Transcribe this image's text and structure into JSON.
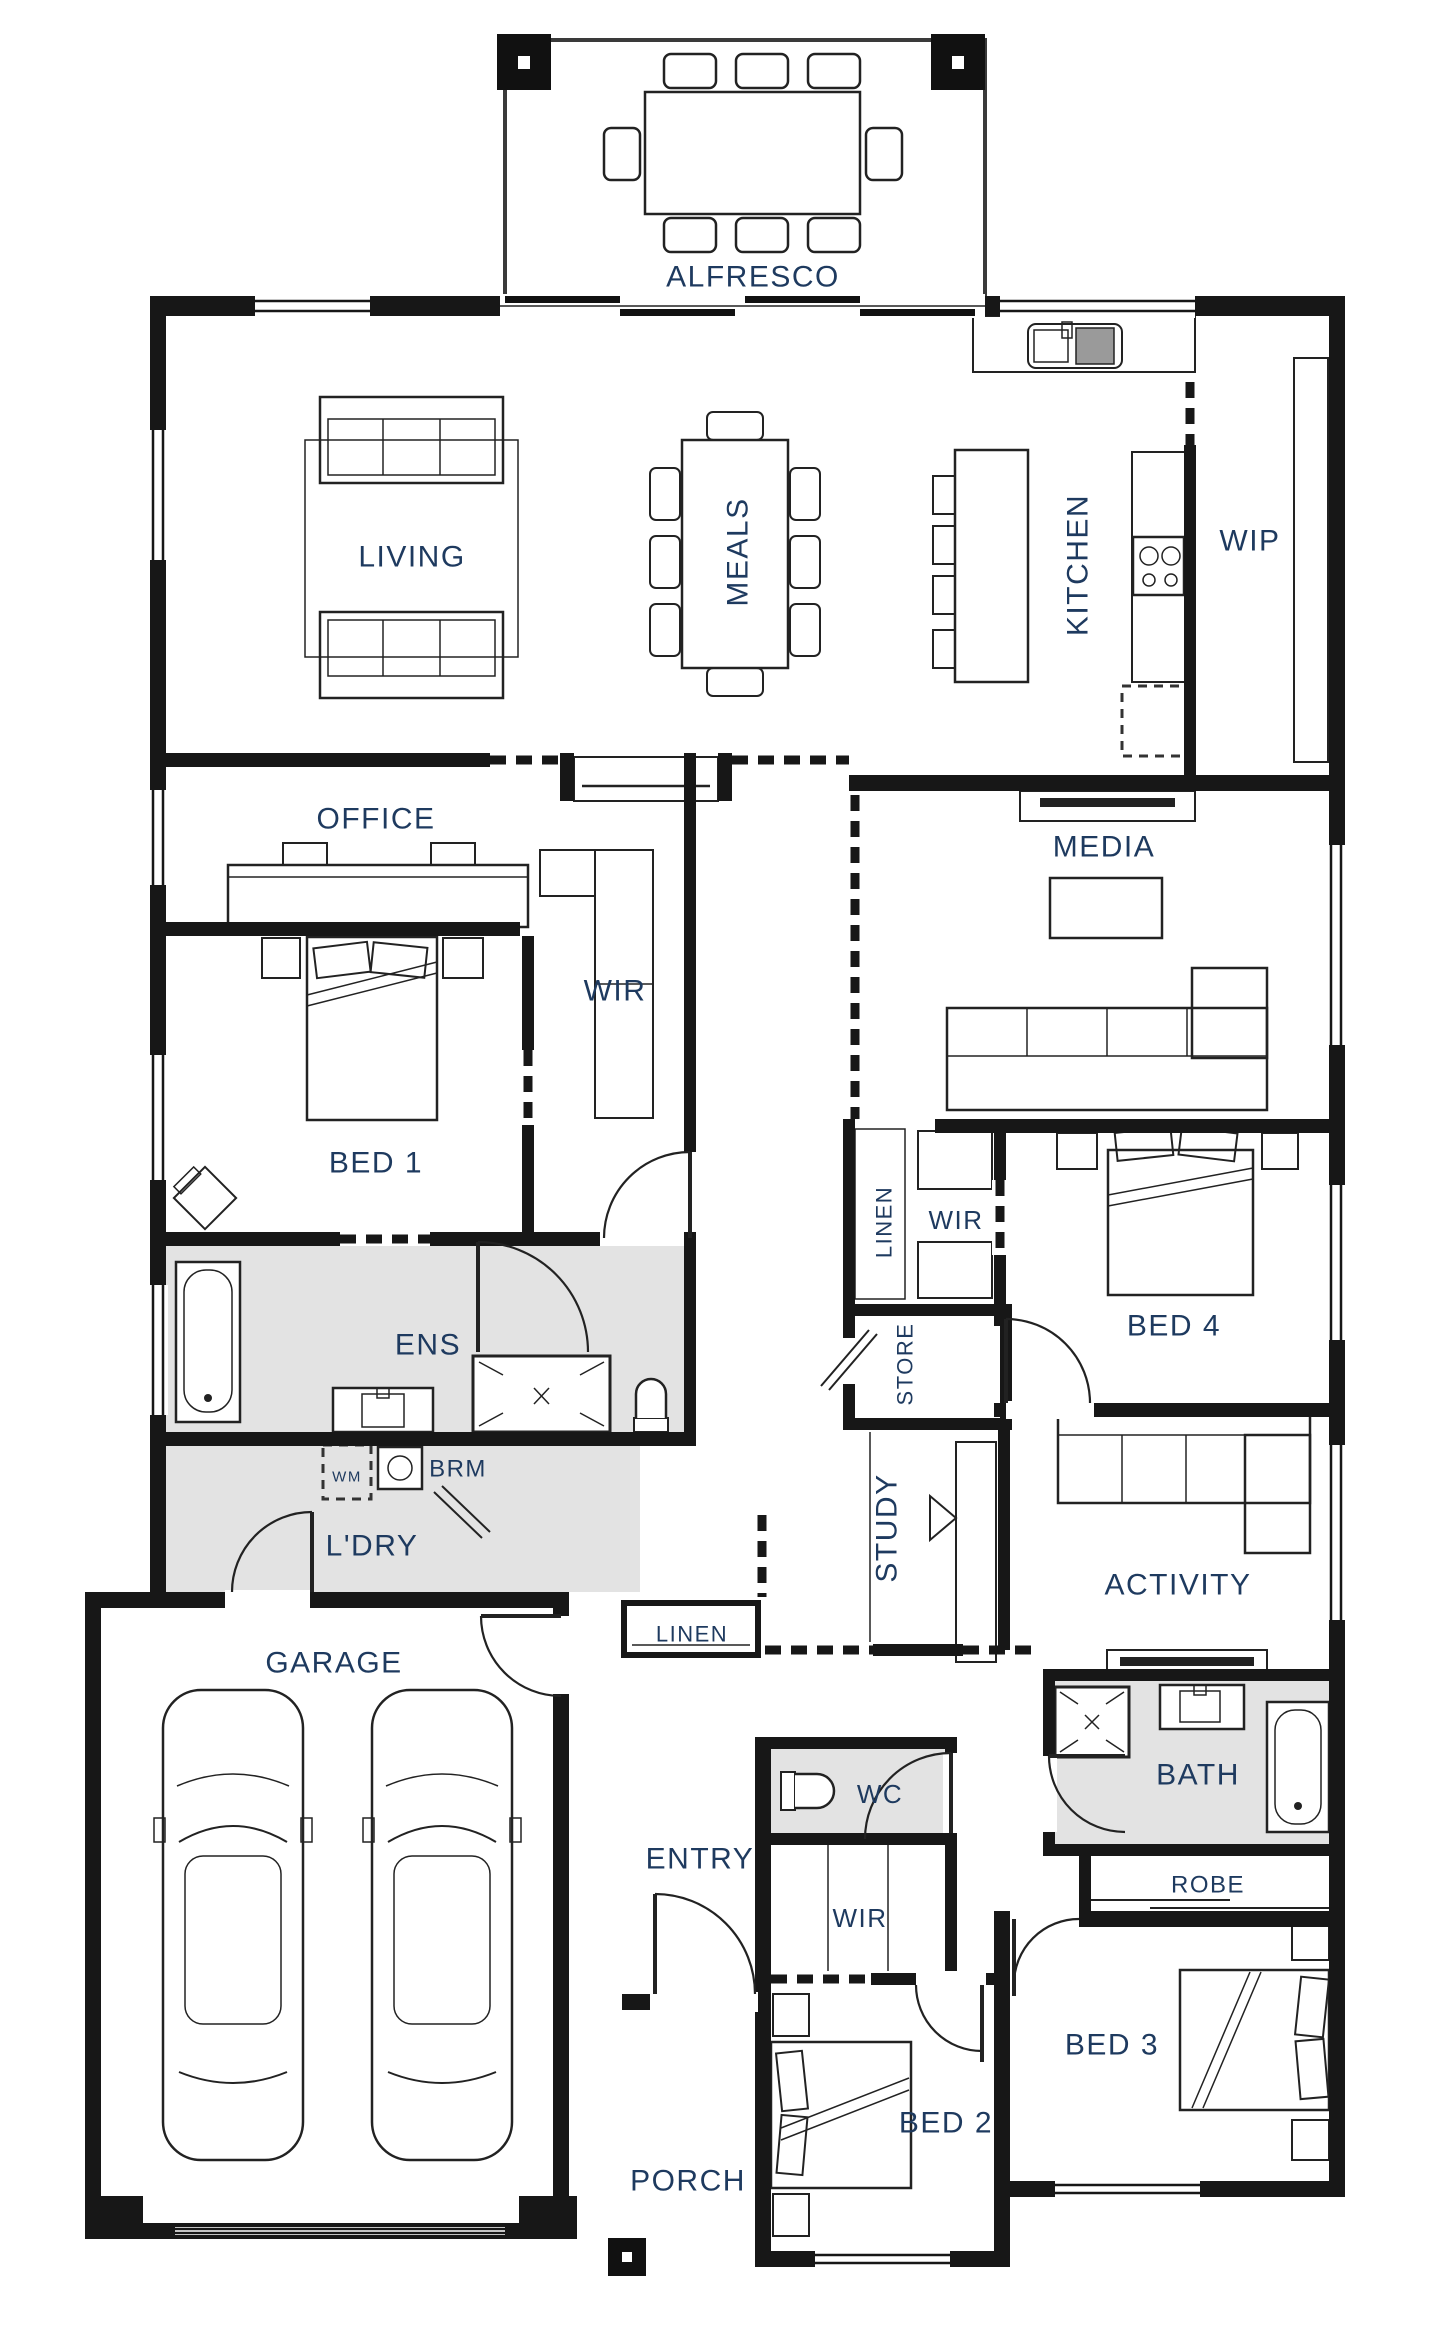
{
  "plan": {
    "type": "residential-floor-plan",
    "colors": {
      "wall": "#171717",
      "label": "#1e3a5f",
      "wet_area": "#e3e3e3",
      "furniture_line": "#222222",
      "background": "#ffffff"
    },
    "canvas": {
      "width": 1440,
      "height": 2340
    },
    "rooms": [
      {
        "id": "alfresco",
        "label": "ALFRESCO",
        "x": 753,
        "y": 276,
        "size": 30,
        "rotate": 0
      },
      {
        "id": "living",
        "label": "LIVING",
        "x": 412,
        "y": 556,
        "size": 30,
        "rotate": 0
      },
      {
        "id": "meals",
        "label": "MEALS",
        "x": 737,
        "y": 552,
        "size": 30,
        "rotate": -90
      },
      {
        "id": "kitchen",
        "label": "KITCHEN",
        "x": 1077,
        "y": 565,
        "size": 30,
        "rotate": -90
      },
      {
        "id": "wip",
        "label": "WIP",
        "x": 1250,
        "y": 540,
        "size": 30,
        "rotate": 0
      },
      {
        "id": "office",
        "label": "OFFICE",
        "x": 376,
        "y": 818,
        "size": 30,
        "rotate": 0
      },
      {
        "id": "media",
        "label": "MEDIA",
        "x": 1104,
        "y": 846,
        "size": 30,
        "rotate": 0
      },
      {
        "id": "wir-bed1",
        "label": "WIR",
        "x": 615,
        "y": 990,
        "size": 30,
        "rotate": 0
      },
      {
        "id": "bed1",
        "label": "BED 1",
        "x": 376,
        "y": 1162,
        "size": 30,
        "rotate": 0
      },
      {
        "id": "linen-hall",
        "label": "LINEN",
        "x": 884,
        "y": 1222,
        "size": 22,
        "rotate": -90
      },
      {
        "id": "wir-bed4",
        "label": "WIR",
        "x": 956,
        "y": 1220,
        "size": 26,
        "rotate": 0
      },
      {
        "id": "bed4",
        "label": "BED 4",
        "x": 1174,
        "y": 1325,
        "size": 30,
        "rotate": 0
      },
      {
        "id": "ens",
        "label": "ENS",
        "x": 428,
        "y": 1344,
        "size": 30,
        "rotate": 0
      },
      {
        "id": "store",
        "label": "STORE",
        "x": 905,
        "y": 1364,
        "size": 22,
        "rotate": -90
      },
      {
        "id": "wm",
        "label": "WM",
        "x": 347,
        "y": 1476,
        "size": 15,
        "rotate": 0
      },
      {
        "id": "brm",
        "label": "BRM",
        "x": 458,
        "y": 1468,
        "size": 24,
        "rotate": 0
      },
      {
        "id": "ldry",
        "label": "L'DRY",
        "x": 372,
        "y": 1545,
        "size": 30,
        "rotate": 0
      },
      {
        "id": "study",
        "label": "STUDY",
        "x": 886,
        "y": 1528,
        "size": 30,
        "rotate": -90
      },
      {
        "id": "activity",
        "label": "ACTIVITY",
        "x": 1178,
        "y": 1584,
        "size": 30,
        "rotate": 0
      },
      {
        "id": "garage",
        "label": "GARAGE",
        "x": 334,
        "y": 1662,
        "size": 30,
        "rotate": 0
      },
      {
        "id": "linen-entry",
        "label": "LINEN",
        "x": 692,
        "y": 1634,
        "size": 22,
        "rotate": 0
      },
      {
        "id": "entry",
        "label": "ENTRY",
        "x": 700,
        "y": 1858,
        "size": 30,
        "rotate": 0
      },
      {
        "id": "wc",
        "label": "WC",
        "x": 880,
        "y": 1794,
        "size": 26,
        "rotate": 0
      },
      {
        "id": "bath",
        "label": "BATH",
        "x": 1198,
        "y": 1774,
        "size": 30,
        "rotate": 0
      },
      {
        "id": "robe",
        "label": "ROBE",
        "x": 1208,
        "y": 1884,
        "size": 24,
        "rotate": 0
      },
      {
        "id": "wir-bed2",
        "label": "WIR",
        "x": 860,
        "y": 1918,
        "size": 26,
        "rotate": 0
      },
      {
        "id": "bed3",
        "label": "BED 3",
        "x": 1112,
        "y": 2044,
        "size": 30,
        "rotate": 0
      },
      {
        "id": "bed2",
        "label": "BED 2",
        "x": 946,
        "y": 2122,
        "size": 30,
        "rotate": 0
      },
      {
        "id": "porch",
        "label": "PORCH",
        "x": 688,
        "y": 2180,
        "size": 30,
        "rotate": 0
      }
    ]
  }
}
